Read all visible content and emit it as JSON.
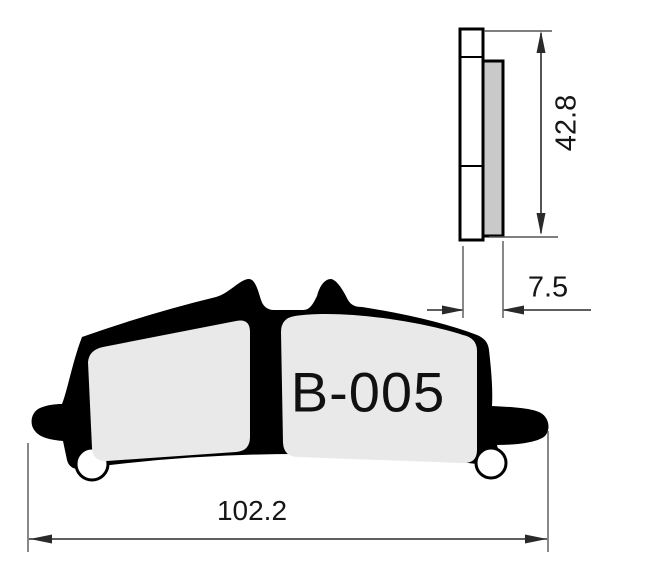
{
  "labels": {
    "part": "B-005"
  },
  "dimensions": {
    "overall_height": "42.8",
    "back_plate_thickness": "7.5",
    "overall_width": "102.2"
  },
  "colors": {
    "background": "#ffffff",
    "outline": "#000000",
    "pad-face": "#e9e9e9",
    "friction-side": "#c9c9c9",
    "plate-side": "#ffffff",
    "dim-line": "#2a2a2a",
    "text": "#111111"
  }
}
